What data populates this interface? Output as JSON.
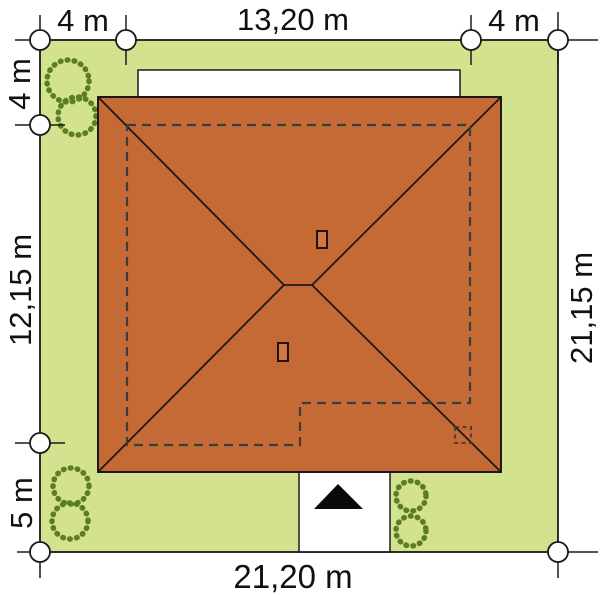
{
  "plan": {
    "type": "house-site-plan-roof-view",
    "dimensions": {
      "top_offset_left": "4 m",
      "top_width": "13,20 m",
      "top_offset_right": "4 m",
      "left_offset_top": "4 m",
      "left_height": "12,15 m",
      "left_offset_bottom": "5 m",
      "right_height": "21,15 m",
      "bottom_width": "21,20 m"
    },
    "colors": {
      "plot_green": "#d3e28f",
      "roof_terracotta": "#c56a34",
      "chimney_fill": "#cf7a45",
      "tree_green": "#5b7d24",
      "outline": "#1a1a1a",
      "dashed_outline": "#3c3c3c",
      "entrance_arrow": "#0a0a0a",
      "background": "#ffffff"
    }
  }
}
